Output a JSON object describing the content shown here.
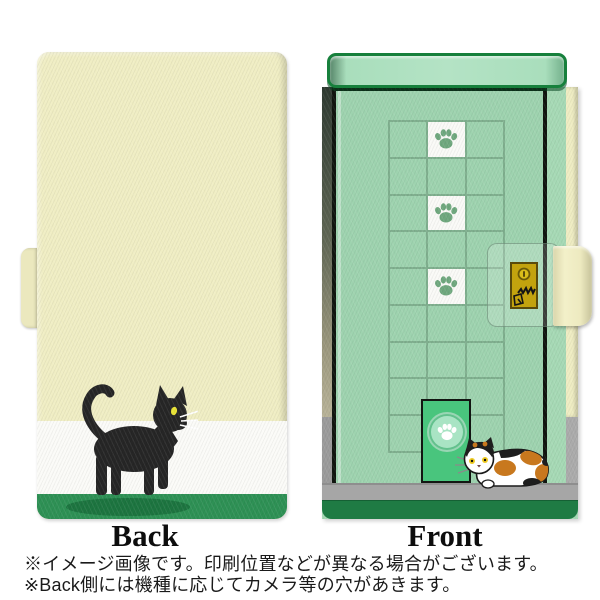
{
  "product_preview": {
    "back": {
      "label": "Back",
      "design": {
        "illustration": "black-cat-walking",
        "base_color": "#F0EEC4",
        "white_band_color": "#FBFBF8",
        "green_band_color": "#2E9155",
        "cat_shadow_color": "#1D7540",
        "cat_body_color": "#262626",
        "cat_eye_color": "#E9E436",
        "whisker_color": "#FFFFFF"
      }
    },
    "front": {
      "label": "Front",
      "design": {
        "illustration": "calico-cat-by-cat-door",
        "door_green": "#9ED3AF",
        "lintel_green": "#A9DEBC",
        "lintel_border_green": "#17803C",
        "grid_line_color": "#7FAF8E",
        "paw_tile_color": "#FAFAF7",
        "paw_print_color": "#6FA87E",
        "paw_tile_count": 3,
        "cat_door_green": "#49C57D",
        "floor_gray": "#A6A6A6",
        "bottom_band_green": "#1F7B44",
        "case_edge_cream": "#EFEDC3",
        "clasp_plate_gold": "#C3A30E",
        "calico_orange": "#C8781E",
        "calico_black": "#1E1E1E",
        "calico_eye_color": "#EFCB22"
      }
    }
  },
  "notes": [
    "※イメージ画像です。印刷位置などが異なる場合がございます。",
    "※Back側には機種に応じてカメラ等の穴があきます。"
  ]
}
